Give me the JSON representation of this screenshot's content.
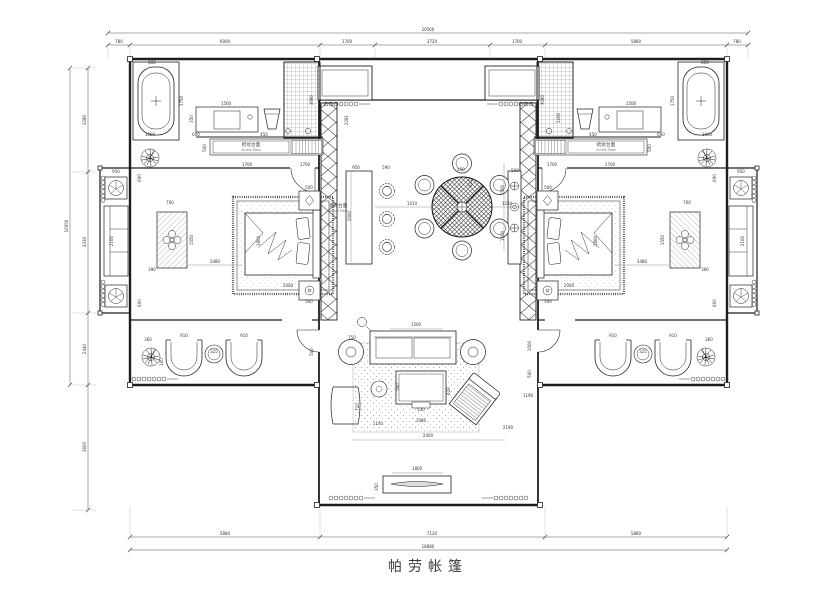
{
  "title": "帕劳帐篷",
  "colors": {
    "line": "#222222",
    "dim_text": "#333333",
    "background": "#ffffff"
  },
  "labels": {
    "vanity_counter_zh": "梳妆台面",
    "vanity_counter_en": "Accent Table",
    "decor_counter_zh": "装饰台面",
    "decor_counter_en": "Accent Table"
  },
  "dims": {
    "top": {
      "total": "20560",
      "segments": [
        "780",
        "6000",
        "1700",
        "3720",
        "1700",
        "5880",
        "780"
      ]
    },
    "bottom": {
      "total": "18880",
      "segments": [
        "5880",
        "7120",
        "5880"
      ]
    },
    "left": {
      "total": "10050",
      "segments": [
        "3280",
        "4330",
        "2440"
      ],
      "extension": "3600"
    }
  },
  "annotations": [
    {
      "t": "20560",
      "x": 428,
      "y": 31
    },
    {
      "t": "780",
      "x": 119,
      "y": 43
    },
    {
      "t": "6000",
      "x": 225,
      "y": 43
    },
    {
      "t": "1700",
      "x": 347,
      "y": 43
    },
    {
      "t": "3720",
      "x": 432,
      "y": 43
    },
    {
      "t": "1700",
      "x": 517,
      "y": 43
    },
    {
      "t": "5880",
      "x": 636,
      "y": 43
    },
    {
      "t": "780",
      "x": 737,
      "y": 43
    },
    {
      "t": "5880",
      "x": 225,
      "y": 535
    },
    {
      "t": "7120",
      "x": 432,
      "y": 535
    },
    {
      "t": "5880",
      "x": 636,
      "y": 535
    },
    {
      "t": "18880",
      "x": 428,
      "y": 548
    },
    {
      "t": "10050",
      "x": 68,
      "y": 226,
      "r": -90
    },
    {
      "t": "3280",
      "x": 86,
      "y": 120,
      "r": -90
    },
    {
      "t": "4330",
      "x": 86,
      "y": 242,
      "r": -90
    },
    {
      "t": "2440",
      "x": 86,
      "y": 349,
      "r": -90
    },
    {
      "t": "3600",
      "x": 86,
      "y": 447,
      "r": -90
    },
    {
      "t": "800",
      "x": 152,
      "y": 64
    },
    {
      "t": "1750",
      "x": 183,
      "y": 101,
      "r": -90
    },
    {
      "t": "1000",
      "x": 150,
      "y": 136
    },
    {
      "t": "1500",
      "x": 226,
      "y": 105
    },
    {
      "t": "350",
      "x": 193,
      "y": 119,
      "r": -90
    },
    {
      "t": "600",
      "x": 196,
      "y": 136
    },
    {
      "t": "450",
      "x": 264,
      "y": 136
    },
    {
      "t": "3080",
      "x": 313,
      "y": 100,
      "r": -90
    },
    {
      "t": "500",
      "x": 206,
      "y": 148,
      "r": -90
    },
    {
      "t": "1700",
      "x": 247,
      "y": 166
    },
    {
      "t": "1700",
      "x": 305,
      "y": 166
    },
    {
      "t": "梳妆台面",
      "x": 251,
      "y": 146,
      "cls": "label"
    },
    {
      "t": "Accent Table",
      "x": 251,
      "y": 151,
      "cls": "sublabel"
    },
    {
      "t": "800",
      "x": 705,
      "y": 64
    },
    {
      "t": "1750",
      "x": 674,
      "y": 101,
      "r": -90
    },
    {
      "t": "1000",
      "x": 707,
      "y": 136
    },
    {
      "t": "1500",
      "x": 631,
      "y": 105
    },
    {
      "t": "600",
      "x": 661,
      "y": 136
    },
    {
      "t": "450",
      "x": 593,
      "y": 136
    },
    {
      "t": "3080",
      "x": 544,
      "y": 100,
      "r": -90
    },
    {
      "t": "1200",
      "x": 560,
      "y": 118,
      "r": -90
    },
    {
      "t": "500",
      "x": 651,
      "y": 148,
      "r": -90
    },
    {
      "t": "1700",
      "x": 610,
      "y": 166
    },
    {
      "t": "1700",
      "x": 552,
      "y": 166
    },
    {
      "t": "梳妆台面",
      "x": 606,
      "y": 146,
      "cls": "label"
    },
    {
      "t": "Accent Table",
      "x": 606,
      "y": 151,
      "cls": "sublabel"
    },
    {
      "t": "950",
      "x": 116,
      "y": 173
    },
    {
      "t": "600",
      "x": 141,
      "y": 178,
      "r": -90
    },
    {
      "t": "2100",
      "x": 113,
      "y": 241,
      "r": -90
    },
    {
      "t": "600",
      "x": 141,
      "y": 303,
      "r": -90
    },
    {
      "t": "700",
      "x": 170,
      "y": 204
    },
    {
      "t": "1550",
      "x": 193,
      "y": 240,
      "r": -90
    },
    {
      "t": "390",
      "x": 152,
      "y": 271
    },
    {
      "t": "3480",
      "x": 215,
      "y": 263
    },
    {
      "t": "950",
      "x": 741,
      "y": 173
    },
    {
      "t": "600",
      "x": 716,
      "y": 178,
      "r": -90
    },
    {
      "t": "2100",
      "x": 744,
      "y": 241,
      "r": -90
    },
    {
      "t": "600",
      "x": 716,
      "y": 303,
      "r": -90
    },
    {
      "t": "700",
      "x": 687,
      "y": 204
    },
    {
      "t": "1550",
      "x": 664,
      "y": 240,
      "r": -90
    },
    {
      "t": "390",
      "x": 705,
      "y": 271
    },
    {
      "t": "3480",
      "x": 642,
      "y": 263
    },
    {
      "t": "1800",
      "x": 260,
      "y": 241,
      "r": -90
    },
    {
      "t": "2000",
      "x": 288,
      "y": 287
    },
    {
      "t": "500",
      "x": 309,
      "y": 189
    },
    {
      "t": "500",
      "x": 309,
      "y": 303
    },
    {
      "t": "1800",
      "x": 597,
      "y": 241,
      "r": -90
    },
    {
      "t": "2000",
      "x": 569,
      "y": 287
    },
    {
      "t": "500",
      "x": 548,
      "y": 189
    },
    {
      "t": "500",
      "x": 548,
      "y": 303
    },
    {
      "t": "360",
      "x": 148,
      "y": 341
    },
    {
      "t": "910",
      "x": 184,
      "y": 337
    },
    {
      "t": "325",
      "x": 214,
      "y": 353
    },
    {
      "t": "910",
      "x": 244,
      "y": 337
    },
    {
      "t": "100",
      "x": 163,
      "y": 362,
      "r": -90
    },
    {
      "t": "500",
      "x": 313,
      "y": 352,
      "r": -90
    },
    {
      "t": "910",
      "x": 613,
      "y": 337
    },
    {
      "t": "325",
      "x": 643,
      "y": 353
    },
    {
      "t": "910",
      "x": 673,
      "y": 337
    },
    {
      "t": "360",
      "x": 709,
      "y": 341
    },
    {
      "t": "1000",
      "x": 531,
      "y": 346,
      "r": -90
    },
    {
      "t": "500",
      "x": 531,
      "y": 374,
      "r": -90
    },
    {
      "t": "1190",
      "x": 528,
      "y": 397
    },
    {
      "t": "2281",
      "x": 348,
      "y": 120,
      "r": -90
    },
    {
      "t": "950",
      "x": 356,
      "y": 169
    },
    {
      "t": "590",
      "x": 386,
      "y": 169
    },
    {
      "t": "2000",
      "x": 351,
      "y": 216,
      "r": -90
    },
    {
      "t": "1014",
      "x": 412,
      "y": 205
    },
    {
      "t": "450",
      "x": 461,
      "y": 171
    },
    {
      "t": "512",
      "x": 472,
      "y": 183,
      "r": -90
    },
    {
      "t": "1234",
      "x": 507,
      "y": 205
    },
    {
      "t": "500",
      "x": 515,
      "y": 172
    },
    {
      "t": "1500",
      "x": 504,
      "y": 190,
      "r": -90
    },
    {
      "t": "1500",
      "x": 504,
      "y": 236,
      "r": -90
    },
    {
      "t": "装饰台面",
      "x": 338,
      "y": 207,
      "cls": "label"
    },
    {
      "t": "Accent Table",
      "x": 338,
      "y": 212,
      "cls": "sublabel"
    },
    {
      "t": "1500",
      "x": 416,
      "y": 326
    },
    {
      "t": "750",
      "x": 352,
      "y": 339
    },
    {
      "t": "500",
      "x": 399,
      "y": 387,
      "r": -90
    },
    {
      "t": "620",
      "x": 450,
      "y": 391,
      "r": -90
    },
    {
      "t": "520",
      "x": 421,
      "y": 411
    },
    {
      "t": "1080",
      "x": 421,
      "y": 422
    },
    {
      "t": "720",
      "x": 359,
      "y": 407,
      "r": -90
    },
    {
      "t": "1140",
      "x": 378,
      "y": 425
    },
    {
      "t": "2400",
      "x": 428,
      "y": 437
    },
    {
      "t": "2190",
      "x": 508,
      "y": 429
    },
    {
      "t": "1800",
      "x": 417,
      "y": 470
    },
    {
      "t": "350",
      "x": 378,
      "y": 487,
      "r": -90
    }
  ]
}
